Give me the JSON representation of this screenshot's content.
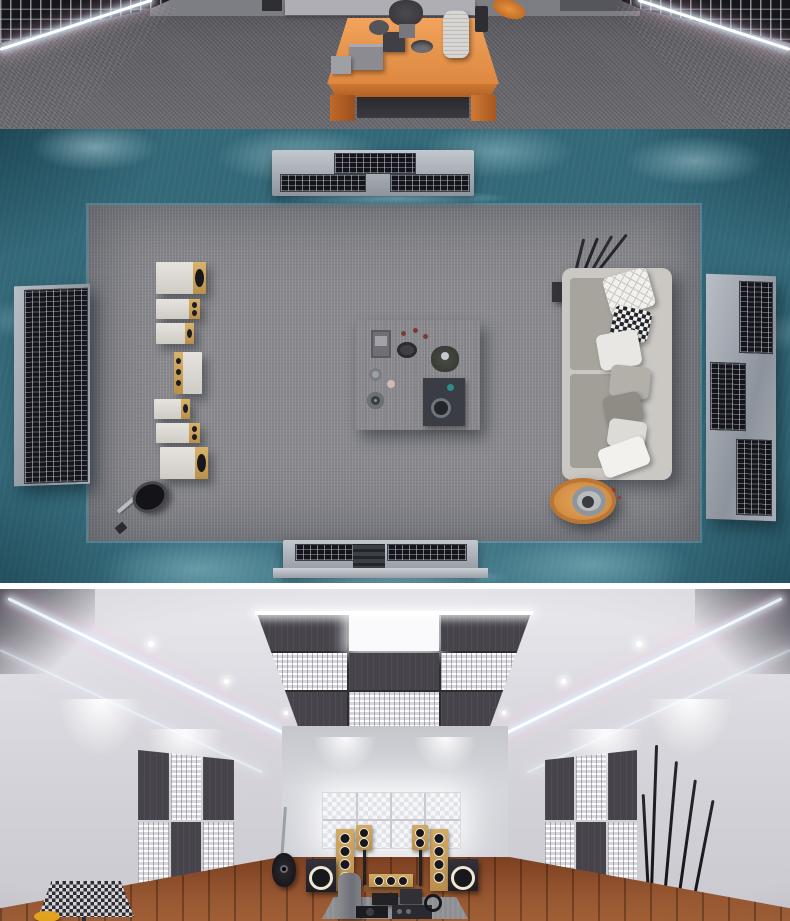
{
  "meta": {
    "kind": "image-collage",
    "description": "Three 3D interior renders of an acoustically treated hi-fi listening room, stacked vertically"
  },
  "palette": {
    "teal_wall_light": "#5fa0bd",
    "teal_wall_mid": "#336878",
    "teal_wall_dark": "#1c4654",
    "carpet_gray": "#8f8f94",
    "carpet_dark": "#64646a",
    "wood_orange": "#e08a43",
    "wood_floor_brown": "#8a4a28",
    "sofa_gray": "#b9b6b1",
    "panel_dark": "#46434b",
    "diffuser_white": "#f1f1f4",
    "led_glow": "#d7f0ff",
    "bright_wall": "#d7d7dc",
    "speaker_birch": "#c9a158",
    "console_silver": "#a9aeb6"
  },
  "panels": [
    {
      "id": "front-room",
      "label": "Dark listening room: teal fabric walls with LED strips, slatted absorber panels, orange wooden coffee table with vases, plant, boxes and bowl on gray carpet",
      "objects": [
        "led-strip-left",
        "led-strip-right",
        "absorber-grid-left",
        "absorber-grid-right",
        "coffee-table",
        "vase",
        "plant",
        "gray-boxes",
        "bowl",
        "guitar-edge"
      ]
    },
    {
      "id": "plan-view",
      "label": "Top-down plan of the room: teal fabric walls, gray carpet, media consoles top and bottom, seven speakers in a column, coffee table with tea set, gray sofa with patterned pillows, round side table, guitar and diffuser wall panels",
      "objects": [
        "media-console-top",
        "media-console-bottom",
        "diffuser-panel-left",
        "diffuser-panel-right",
        "speaker-column",
        "coffee-table",
        "sofa",
        "pillows",
        "round-side-table",
        "guitar",
        "stick-decor"
      ]
    },
    {
      "id": "bright-room",
      "label": "Bright room: white ceiling with LED strips and checkerboard absorber-diffuser cloud, glowing diffuser window, checkerboard wall panels, birch tower and bookshelf speakers, subwoofers, center channel, guitar, stick lamps, patterned stool on wood floor",
      "objects": [
        "ceiling-cloud",
        "led-strips",
        "downlights",
        "diffuser-window",
        "wall-panel-left",
        "wall-panel-right",
        "tower-speakers",
        "stand-speakers",
        "subwoofers",
        "center-channel",
        "guitar-on-stand",
        "gear-pile",
        "stick-lamps",
        "patterned-stool",
        "yellow-object"
      ]
    }
  ]
}
